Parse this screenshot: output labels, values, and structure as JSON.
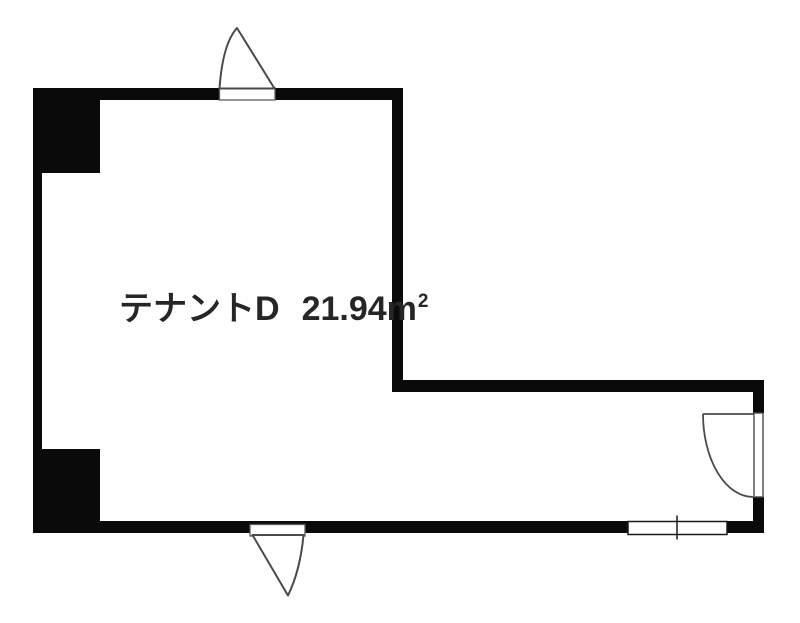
{
  "plan": {
    "tenant_label": "テナントD",
    "area_value": "21.94",
    "area_unit_base": "m",
    "area_unit_exponent": "2",
    "colors": {
      "wall": "#0a0a0a",
      "symbol_line": "#4a4a4a",
      "frame_line": "#1a1a1a",
      "opening_line": "#5a5a5a",
      "text": "#262626",
      "background": "#ffffff"
    },
    "symbols": {
      "top_door": "swing-door",
      "bottom_door": "swing-door",
      "right_door": "hinged-door-with-arc",
      "bottom_window": "sliding-window",
      "top_left_column": "solid-column",
      "bottom_left_column": "solid-column"
    }
  }
}
